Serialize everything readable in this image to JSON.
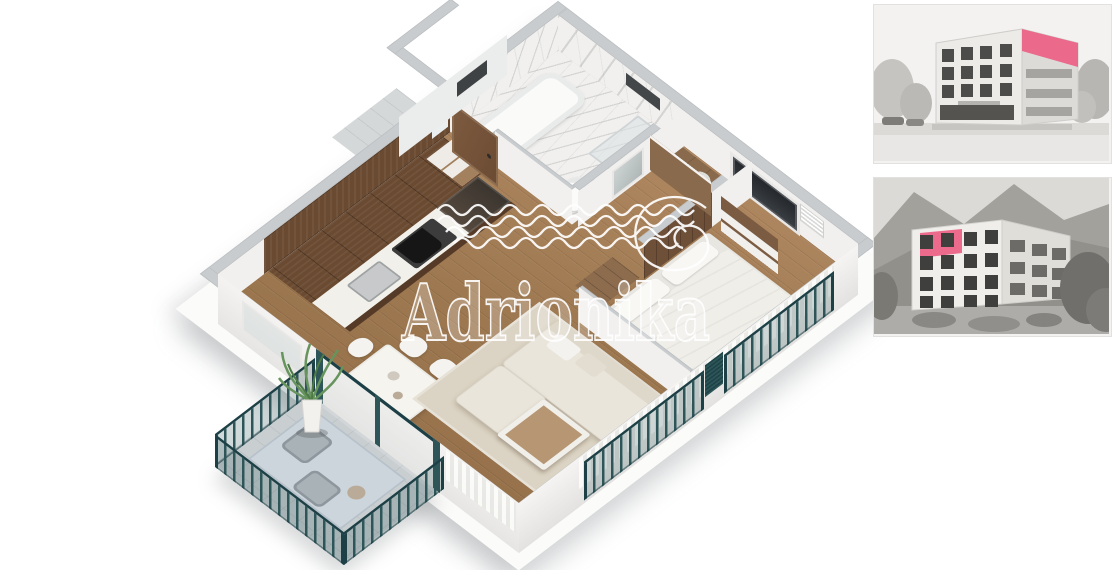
{
  "watermark": {
    "text": "Adrionika"
  },
  "colors": {
    "background": "#ffffff",
    "wall_cap": "#c8ccce",
    "wall_face": "#f1f0ee",
    "plinth": "#fbfbfa",
    "floor_wood": "#a57e58",
    "kitchen_wood": "#6a4a31",
    "cabinet_front": "#553a27",
    "headboard_wood": "#6e4f38",
    "closet_wood": "#7b5c43",
    "marble": "#f1f0ee",
    "railing_teal": "#2e5659",
    "railing_teal_dark": "#1c4046",
    "sofa_cream": "#eae5da",
    "rug_beige": "#dbd3c3",
    "bed_linen": "#f0eee9",
    "table_white": "#f6f4ef",
    "balcony_tile": "#c9ced1",
    "balcony_rug": "#ccd5db",
    "accent_pink": "#ec5f84",
    "photo_bg": "#f4f2f0",
    "photo_building": "#edebe8",
    "photo_side": "#dddbd7",
    "photo_window": "#4c4c4a",
    "photo_green": "#8f8d88"
  },
  "floorplan": {
    "type": "3d-isometric-apartment-render",
    "rooms": [
      {
        "name": "entrance-hall"
      },
      {
        "name": "bathroom"
      },
      {
        "name": "kitchen"
      },
      {
        "name": "dining-area"
      },
      {
        "name": "living-room"
      },
      {
        "name": "bedroom"
      },
      {
        "name": "balcony-terrace"
      }
    ],
    "features": [
      "entrance-door",
      "french-balconies-teal",
      "terrace-plant",
      "kitchen-run-with-cooktop-and-sink",
      "corner-sofa",
      "double-bed",
      "bathtub-and-shower"
    ]
  },
  "photos": [
    {
      "label": "building exterior render, street view, grayscale, unit highlighted pink at top-right corner",
      "highlight_position": "top-right"
    },
    {
      "label": "building exterior render, hillside view, grayscale, unit highlighted pink at top-left",
      "highlight_position": "top-left"
    }
  ]
}
